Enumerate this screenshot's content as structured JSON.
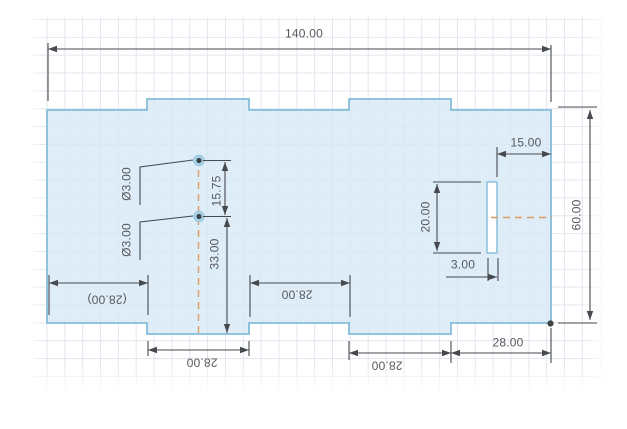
{
  "drawing": {
    "kind": "cad-sketch-dimensioned-plate",
    "dimensions": {
      "overall_width": "140.00",
      "overall_height": "60.00",
      "slot_offset_from_right": "15.00",
      "slot_height": "20.00",
      "slot_width": "3.00",
      "hole_spacing_vertical": "15.75",
      "hole_to_bottom_tab": "33.00",
      "hole_upper_dia": "Ø3.00",
      "hole_lower_dia": "Ø3.00",
      "bottom_left_segment_ref": "(28.00)",
      "bottom_middle_segment": "28.00",
      "bottom_tab_left": "28.00",
      "bottom_tab_right": "28.00",
      "bottom_right_segment": "28.00"
    },
    "colors": {
      "part_fill": "#dcebf7",
      "part_stroke": "#85bdd9",
      "centerline": "#dd9e63",
      "dimension": "#46494d",
      "grid_line": "#e2e6ee"
    }
  }
}
